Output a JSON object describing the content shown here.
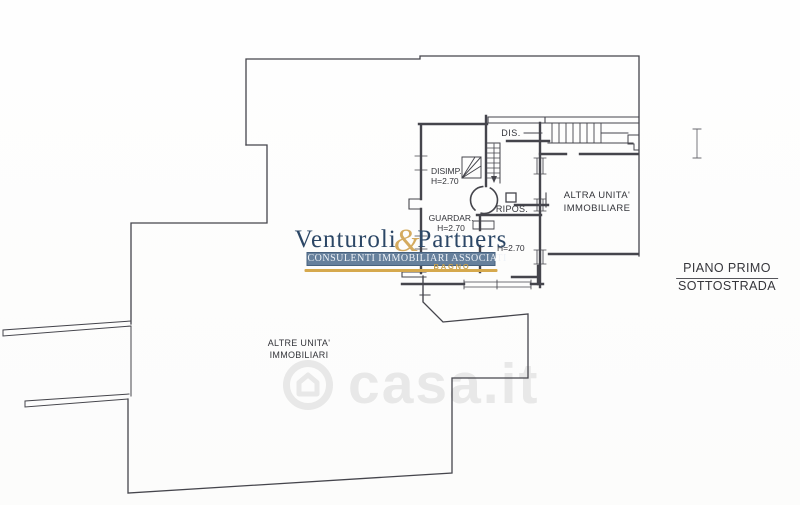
{
  "plan": {
    "labels": {
      "dis": "DIS.",
      "disimp_name": "DISIMP.",
      "disimp_h": "H=2.70",
      "guardar_name": "GUARDAR.",
      "guardar_h": "H=2.70",
      "ripos": "RIPOS.",
      "main_h": "H=2.70",
      "altra_line1": "ALTRA UNITA'",
      "altra_line2": "IMMOBILIARE",
      "altre_line1": "ALTRE UNITA'",
      "altre_line2": "IMMOBILIARI"
    },
    "floor_caption": {
      "line1": "PIANO PRIMO",
      "line2": "SOTTOSTRADA"
    },
    "line_color": "#45454c"
  },
  "watermarks": {
    "agency": {
      "name_left": "Venturoli",
      "ampersand": "&",
      "name_right": "Partners",
      "banner": "CONSULENTI IMMOBILIARI ASSOCIATI",
      "sub": "BAGNO",
      "color_navy": "#2c4766",
      "color_gold": "#d0a24d",
      "color_banner_bg": "#66809c"
    },
    "portal": {
      "text": "casa.it",
      "icon": "house-circle-icon",
      "color": "#e7e7e7"
    }
  }
}
